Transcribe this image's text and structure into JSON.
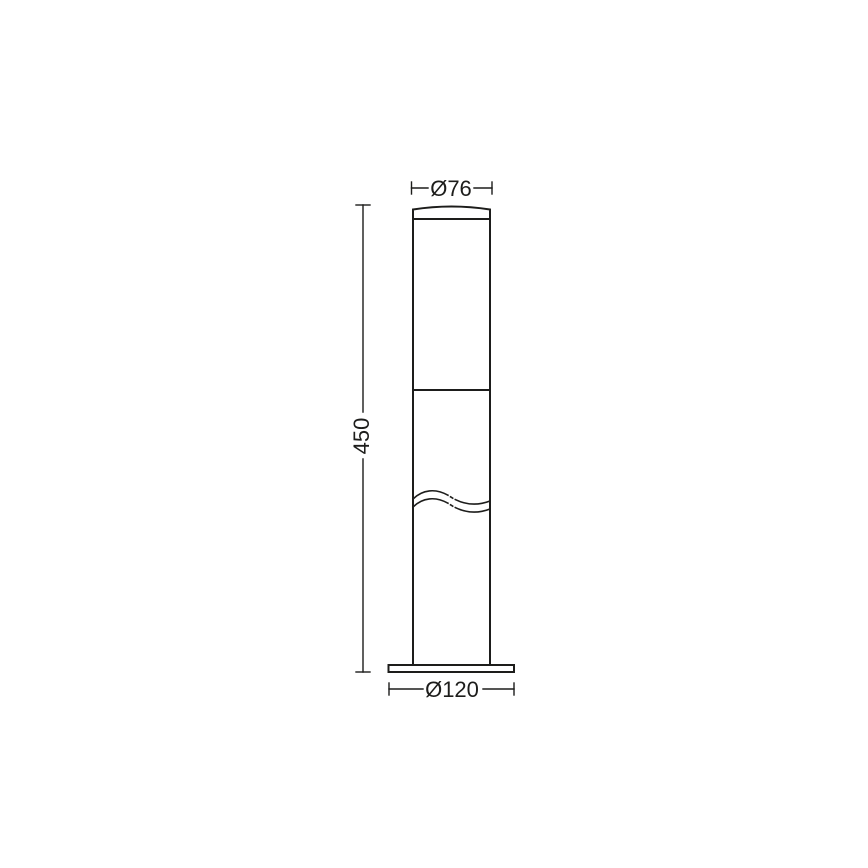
{
  "drawing": {
    "kind": "technical-dimension-drawing",
    "subject": "bollard-light-elevation",
    "stroke_color": "#1d1d1b",
    "text_color": "#1d1d1b",
    "background_color": "#ffffff",
    "dimensions": {
      "top_diameter": {
        "label": "Ø76",
        "value": 76
      },
      "height": {
        "label": "450",
        "value": 450
      },
      "base_diameter": {
        "label": "Ø120",
        "value": 120
      }
    }
  }
}
